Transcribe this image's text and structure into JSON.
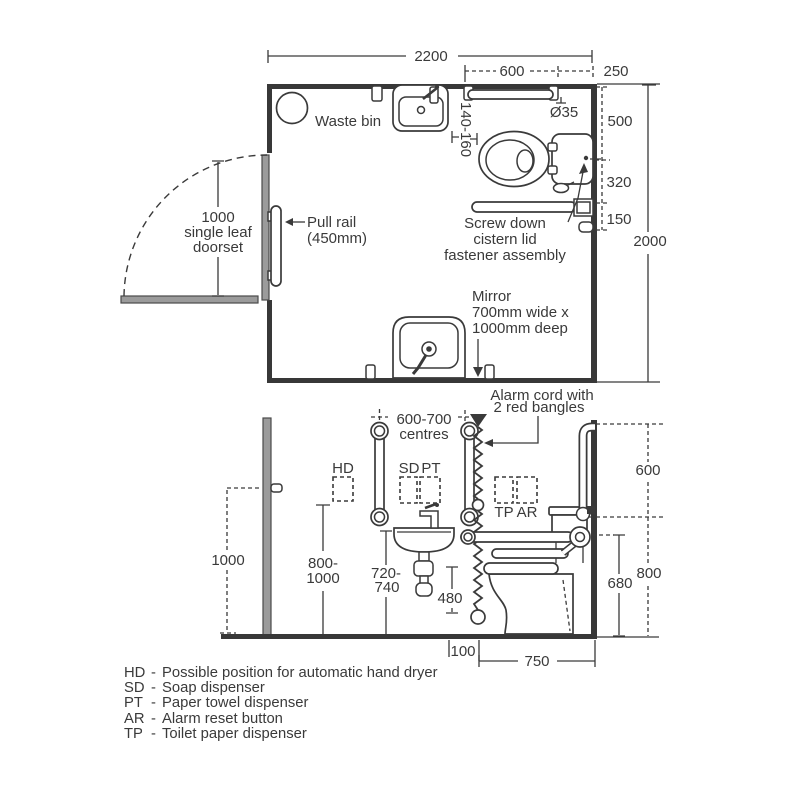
{
  "colors": {
    "ink": "#3a3a3a",
    "fixture_gray": "#9b9b9b"
  },
  "plan": {
    "dim_width": "2200",
    "dim_rail": "600",
    "dim_corner": "250",
    "dim_dia": "Ø35",
    "dim_500": "500",
    "dim_320": "320",
    "dim_150": "150",
    "dim_depth": "2000",
    "dim_gap": "140-160",
    "waste_bin": "Waste bin",
    "door_l1": "1000",
    "door_l2": "single leaf",
    "door_l3": "doorset",
    "pull_l1": "Pull rail",
    "pull_l2": "(450mm)",
    "screw_l1": "Screw down",
    "screw_l2": "cistern lid",
    "screw_l3": "fastener assembly",
    "mirror_l1": "Mirror",
    "mirror_l2": "700mm wide x",
    "mirror_l3": "1000mm deep",
    "alarm_l1": "Alarm cord with",
    "alarm_l2": "2 red bangles"
  },
  "elevation": {
    "dim_1000": "1000",
    "dim_800_1000a": "800-",
    "dim_800_1000b": "1000",
    "centres_l1": "600-700",
    "centres_l2": "centres",
    "hd": "HD",
    "sd": "SD",
    "pt": "PT",
    "tp": "TP",
    "ar": "AR",
    "dim_720a": "720-",
    "dim_720b": "740",
    "dim_480": "480",
    "dim_100": "100",
    "dim_750": "750",
    "dim_600": "600",
    "dim_800": "800",
    "dim_680": "680"
  },
  "legend": {
    "items": [
      {
        "abbr": "HD",
        "sep": "-",
        "desc": "Possible position for automatic hand dryer"
      },
      {
        "abbr": "SD",
        "sep": "-",
        "desc": "Soap dispenser"
      },
      {
        "abbr": "PT",
        "sep": "-",
        "desc": "Paper towel dispenser"
      },
      {
        "abbr": "AR",
        "sep": "-",
        "desc": "Alarm reset button"
      },
      {
        "abbr": "TP",
        "sep": "-",
        "desc": "Toilet paper dispenser"
      }
    ]
  }
}
